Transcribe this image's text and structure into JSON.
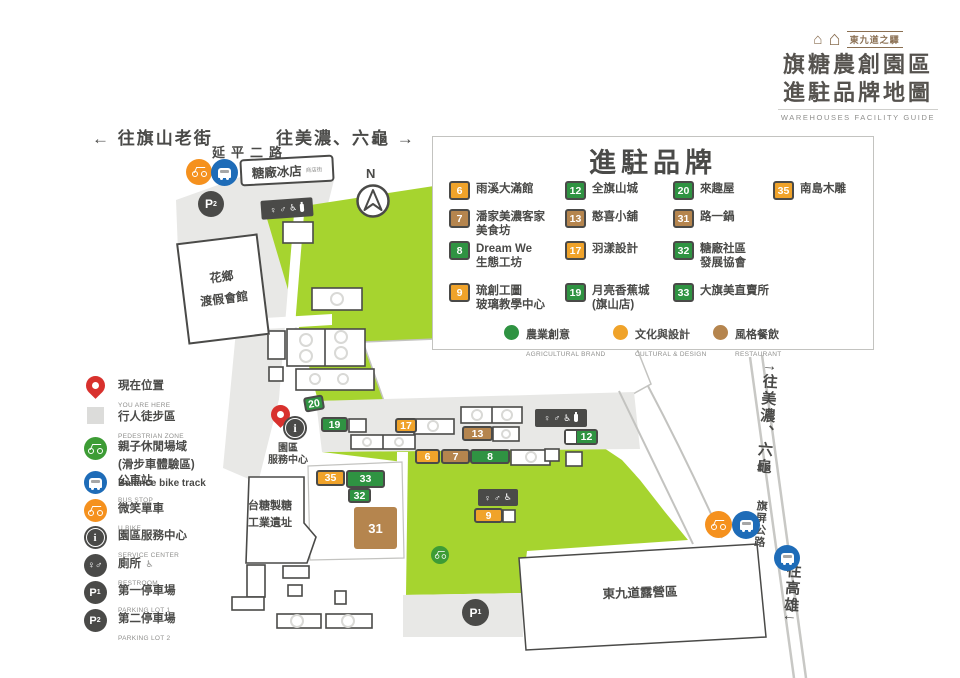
{
  "colors": {
    "green": "#2f9342",
    "yellow": "#f0a32a",
    "brown": "#b5854e",
    "park": "#a6d42f",
    "dark": "#4a4a48",
    "gray_zone": "#e8e8e6",
    "border_gray": "#c3c3c0",
    "red": "#d8312d",
    "blue": "#1e6cb8",
    "orange": "#f5911e",
    "bike_green": "#3d9c35",
    "text_gray": "#8f8f8d",
    "logo_brown": "#8a6f52"
  },
  "icons": {
    "female": "♀",
    "male": "♂",
    "wheelchair": "♿",
    "house": "⌂",
    "info": "i",
    "parking": "P",
    "north": "N",
    "up_arrow": "↑",
    "down_arrow": "↓"
  },
  "title_block": {
    "brand": "東九道之驛",
    "line1": "旗糖農創園區",
    "line2": "進駐品牌地圖",
    "subtitle": "WAREHOUSES FACILITY GUIDE"
  },
  "nav": {
    "to_qishan": "← 往旗山老街",
    "to_meinong_top": "往美濃、六龜 →",
    "road_top": "延平二路"
  },
  "brand_panel": {
    "title": "進駐品牌",
    "items": [
      {
        "num": "6",
        "color": "yellow",
        "name": "雨溪大滿館"
      },
      {
        "num": "12",
        "color": "green",
        "name": "全旗山城"
      },
      {
        "num": "20",
        "color": "green",
        "name": "來趣屋"
      },
      {
        "num": "35",
        "color": "yellow",
        "name": "南島木雕"
      },
      {
        "num": "7",
        "color": "brown",
        "name": "潘家美濃客家\n美食坊"
      },
      {
        "num": "13",
        "color": "brown",
        "name": "憨喜小舖"
      },
      {
        "num": "31",
        "color": "brown",
        "name": "路一鍋"
      },
      {
        "num": "8",
        "color": "green",
        "name": "Dream We\n生態工坊"
      },
      {
        "num": "17",
        "color": "yellow",
        "name": "羽漾設計"
      },
      {
        "num": "32",
        "color": "green",
        "name": "糖廠社區\n發展協會"
      },
      {
        "num": "9",
        "color": "yellow",
        "name": "琉創工圖\n玻璃教學中心"
      },
      {
        "num": "19",
        "color": "green",
        "name": "月亮香蕉城\n(旗山店)"
      },
      {
        "num": "33",
        "color": "green",
        "name": "大旗美直賣所"
      }
    ],
    "categories": [
      {
        "key": "green",
        "zh": "農業創意",
        "en": "AGRICULTURAL BRAND"
      },
      {
        "key": "yellow",
        "zh": "文化與設計",
        "en": "CULTURAL & DESIGN"
      },
      {
        "key": "brown",
        "zh": "風格餐飲",
        "en": "RESTAURANT"
      }
    ]
  },
  "sidebar": {
    "items": [
      {
        "icon": "pin",
        "zh": "現在位置",
        "en": "YOU ARE HERE"
      },
      {
        "icon": "pedestrian-zone",
        "zh": "行人徒步區",
        "en": "PEDESTRIAN ZONE"
      },
      {
        "icon": "balance-bike",
        "zh": "親子休閒場域",
        "zh2": "(滑步車體驗區)",
        "en": "Balance bike track"
      },
      {
        "icon": "bus-stop",
        "zh": "公車站",
        "en": "BUS STOP"
      },
      {
        "icon": "u-bike",
        "zh": "微笑單車",
        "en": "U BIKE"
      },
      {
        "icon": "service-center",
        "zh": "園區服務中心",
        "en": "SERVICE CENTER"
      },
      {
        "icon": "restroom",
        "zh": "廁所",
        "en": "RESTROOM"
      },
      {
        "icon": "parking-1",
        "zh": "第一停車場",
        "en": "PARKING LOT 1",
        "sub": "1"
      },
      {
        "icon": "parking-2",
        "zh": "第二停車場",
        "en": "PARKING LOT 2",
        "sub": "2"
      }
    ]
  },
  "map": {
    "labels": {
      "ice_shop": "糖廠冰店",
      "ice_shop_sub": "商店街",
      "resort": "花鄉\n渡假會館",
      "factory": "台糖製糖\n工業遺址",
      "camping": "東九道露營區",
      "service_center": "園區\n服務中心",
      "highway": "旗屏公路",
      "to_meinong": "往美濃、六龜",
      "to_kaohsiung": "往高雄"
    },
    "parking1_sub": "1",
    "parking2_sub": "2",
    "markers": [
      {
        "num": "20",
        "color": "green"
      },
      {
        "num": "19",
        "color": "green"
      },
      {
        "num": "17",
        "color": "yellow"
      },
      {
        "num": "13",
        "color": "brown"
      },
      {
        "num": "12",
        "color": "green"
      },
      {
        "num": "6",
        "color": "yellow"
      },
      {
        "num": "7",
        "color": "brown"
      },
      {
        "num": "8",
        "color": "green"
      },
      {
        "num": "35",
        "color": "yellow"
      },
      {
        "num": "33",
        "color": "green"
      },
      {
        "num": "32",
        "color": "green"
      },
      {
        "num": "31",
        "color": "brown"
      },
      {
        "num": "9",
        "color": "yellow"
      }
    ]
  }
}
